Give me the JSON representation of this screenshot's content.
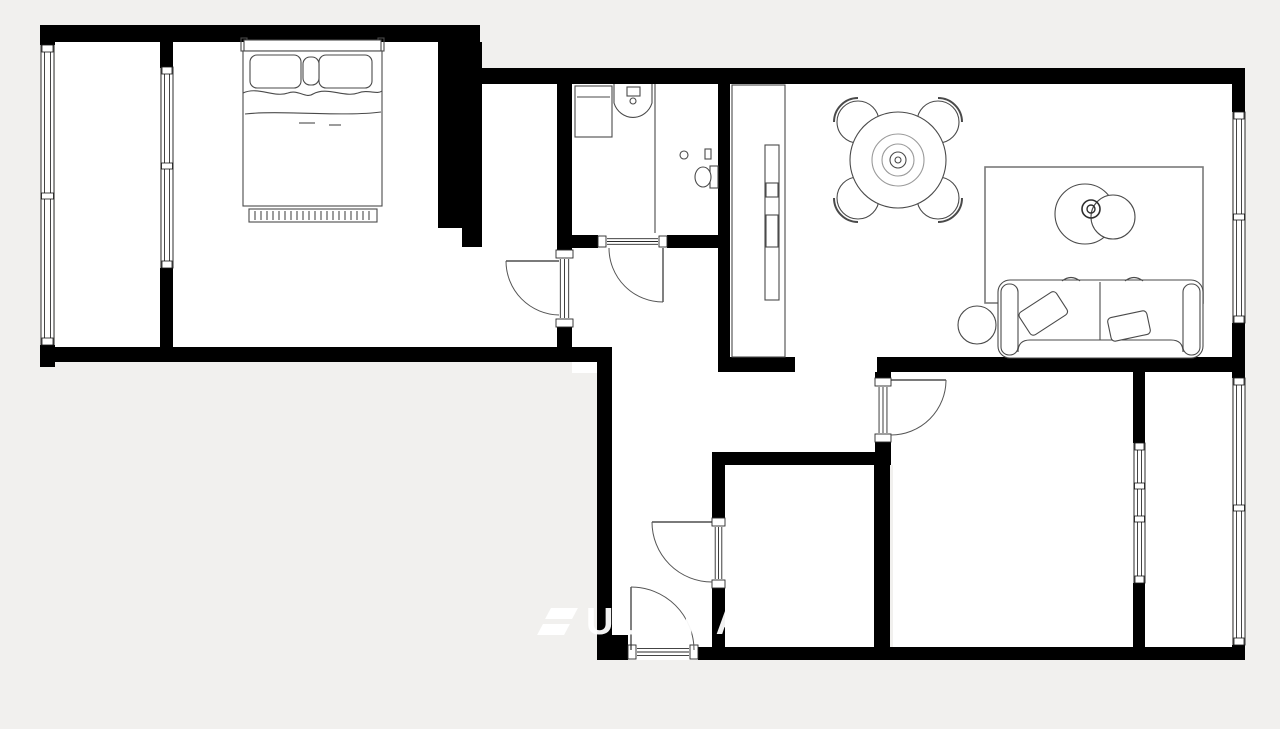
{
  "canvas": {
    "width": 1280,
    "height": 729,
    "bg_color": "#f1f0ee",
    "floor_color": "#ffffff",
    "wall_color": "#000000",
    "furniture_line_color": "#4a4a4a",
    "door_line_color": "#2a2a2a",
    "arc_color": "#555555",
    "window_frame_color": "#161616"
  },
  "watermark": {
    "text": "UUBRA",
    "color": "rgba(255,255,255,0.95)",
    "x": 540,
    "y": 606
  },
  "plan": {
    "floors": [
      {
        "name": "balcony-floor",
        "x": 55,
        "y": 42,
        "w": 105,
        "h": 305
      },
      {
        "name": "bedroom-floor",
        "x": 173,
        "y": 42,
        "w": 265,
        "h": 305
      },
      {
        "name": "bedroom-floor-ext",
        "x": 438,
        "y": 228,
        "w": 44,
        "h": 119
      },
      {
        "name": "bedroom-alcove-floor",
        "x": 474,
        "y": 84,
        "w": 86,
        "h": 263
      },
      {
        "name": "bathroom-floor",
        "x": 572,
        "y": 84,
        "w": 146,
        "h": 151
      },
      {
        "name": "hall-upper-floor",
        "x": 572,
        "y": 235,
        "w": 146,
        "h": 138
      },
      {
        "name": "hall-lower-floor",
        "x": 612,
        "y": 362,
        "w": 100,
        "h": 286
      },
      {
        "name": "corridor-floor",
        "x": 712,
        "y": 372,
        "w": 181,
        "h": 93
      },
      {
        "name": "storage-room-floor",
        "x": 725,
        "y": 465,
        "w": 149,
        "h": 183
      },
      {
        "name": "living-room-floor",
        "x": 730,
        "y": 84,
        "w": 502,
        "h": 288
      },
      {
        "name": "bedroom2-loggia-floor",
        "x": 893,
        "y": 372,
        "w": 339,
        "h": 276
      }
    ],
    "walls": [
      {
        "name": "top-left-wall",
        "x": 40,
        "y": 25,
        "w": 440,
        "h": 17
      },
      {
        "name": "left-wall-top-corner",
        "x": 40,
        "y": 25,
        "w": 15,
        "h": 20
      },
      {
        "name": "left-wall-bottom-corner",
        "x": 40,
        "y": 345,
        "w": 15,
        "h": 22
      },
      {
        "name": "bedroom-bottom-wall",
        "x": 40,
        "y": 347,
        "w": 572,
        "h": 15
      },
      {
        "name": "hall-left-wall",
        "x": 597,
        "y": 362,
        "w": 15,
        "h": 280
      },
      {
        "name": "hall-bottom-step",
        "x": 597,
        "y": 635,
        "w": 31,
        "h": 25
      },
      {
        "name": "top-right-wall",
        "x": 480,
        "y": 68,
        "w": 752,
        "h": 16
      },
      {
        "name": "top-right-corner",
        "x": 1232,
        "y": 68,
        "w": 13,
        "h": 44
      },
      {
        "name": "right-wall-mid-block",
        "x": 1232,
        "y": 323,
        "w": 13,
        "h": 55
      },
      {
        "name": "right-wall-bottom-corner",
        "x": 1232,
        "y": 645,
        "w": 13,
        "h": 15
      },
      {
        "name": "bottom-wall",
        "x": 698,
        "y": 647,
        "w": 547,
        "h": 13
      },
      {
        "name": "bedroom-pillar",
        "x": 438,
        "y": 42,
        "w": 44,
        "h": 186
      },
      {
        "name": "bedroom-pillar-notch",
        "x": 462,
        "y": 228,
        "w": 20,
        "h": 19
      },
      {
        "name": "bathroom-left-wall-upper",
        "x": 557,
        "y": 84,
        "w": 15,
        "h": 166
      },
      {
        "name": "bathroom-left-wall-lower",
        "x": 557,
        "y": 327,
        "w": 15,
        "h": 22
      },
      {
        "name": "bathroom-bottom-wall-left",
        "x": 572,
        "y": 235,
        "w": 26,
        "h": 13
      },
      {
        "name": "bathroom-bottom-wall-right",
        "x": 667,
        "y": 235,
        "w": 51,
        "h": 13
      },
      {
        "name": "bathroom-right-wall",
        "x": 718,
        "y": 84,
        "w": 12,
        "h": 288
      },
      {
        "name": "living-bottom-wall-left",
        "x": 730,
        "y": 357,
        "w": 65,
        "h": 15
      },
      {
        "name": "living-bottom-wall-right",
        "x": 877,
        "y": 357,
        "w": 355,
        "h": 15
      },
      {
        "name": "bedroom2-door-block-top",
        "x": 875,
        "y": 372,
        "w": 16,
        "h": 8
      },
      {
        "name": "bedroom2-door-block-bottom",
        "x": 875,
        "y": 440,
        "w": 16,
        "h": 25
      },
      {
        "name": "storage-top-wall",
        "x": 712,
        "y": 452,
        "w": 178,
        "h": 13
      },
      {
        "name": "storage-left-wall-upper",
        "x": 712,
        "y": 465,
        "w": 13,
        "h": 55
      },
      {
        "name": "storage-left-wall-lower",
        "x": 712,
        "y": 586,
        "w": 13,
        "h": 64
      },
      {
        "name": "storage-right-wall",
        "x": 874,
        "y": 465,
        "w": 16,
        "h": 185
      },
      {
        "name": "loggia-partition-top",
        "x": 1133,
        "y": 372,
        "w": 12,
        "h": 71
      },
      {
        "name": "loggia-partition-bottom",
        "x": 1133,
        "y": 583,
        "w": 12,
        "h": 64
      },
      {
        "name": "balcony-partition-top",
        "x": 160,
        "y": 28,
        "w": 13,
        "h": 40
      },
      {
        "name": "balcony-partition-bottom",
        "x": 160,
        "y": 268,
        "w": 13,
        "h": 79
      }
    ],
    "windows": [
      {
        "name": "balcony-exterior-window",
        "orient": "v",
        "x": 41,
        "y": 45,
        "w": 13,
        "h": 300,
        "dividers": [
          193
        ]
      },
      {
        "name": "bedroom-balcony-partition-window",
        "orient": "v",
        "x": 161,
        "y": 67,
        "w": 12,
        "h": 201,
        "dividers": [
          163
        ]
      },
      {
        "name": "living-room-window",
        "orient": "v",
        "x": 1233,
        "y": 112,
        "w": 12,
        "h": 211,
        "dividers": [
          214
        ]
      },
      {
        "name": "loggia-exterior-window",
        "orient": "v",
        "x": 1233,
        "y": 378,
        "w": 12,
        "h": 267,
        "dividers": [
          505
        ]
      },
      {
        "name": "bedroom2-loggia-partition-window",
        "orient": "v",
        "x": 1134,
        "y": 443,
        "w": 11,
        "h": 140,
        "dividers": [
          483,
          516
        ]
      }
    ],
    "doors": [
      {
        "name": "bedroom-door",
        "orient": "v",
        "threshold": {
          "x": 555,
          "y": 250,
          "w": 19,
          "h": 77
        },
        "leaf": {
          "x1": 506,
          "y1": 261,
          "x2": 559,
          "y2": 261
        },
        "arc": "M506 261 A54 54 0 0 0 559 315"
      },
      {
        "name": "bathroom-door",
        "orient": "h",
        "threshold": {
          "x": 598,
          "y": 235,
          "w": 69,
          "h": 13
        },
        "leaf": {
          "x1": 663,
          "y1": 248,
          "x2": 663,
          "y2": 302
        },
        "arc": "M609 248 A54 54 0 0 0 663 302"
      },
      {
        "name": "storage-door",
        "orient": "v",
        "threshold": {
          "x": 711,
          "y": 518,
          "w": 15,
          "h": 70
        },
        "leaf": {
          "x1": 652,
          "y1": 522,
          "x2": 712,
          "y2": 522
        },
        "arc": "M652 522 A60 60 0 0 0 712 582"
      },
      {
        "name": "bedroom2-door",
        "orient": "v",
        "threshold": {
          "x": 874,
          "y": 378,
          "w": 18,
          "h": 64
        },
        "leaf": {
          "x1": 891,
          "y1": 380,
          "x2": 946,
          "y2": 380
        },
        "arc": "M946 380 A55 55 0 0 1 891 435"
      },
      {
        "name": "entrance-door",
        "orient": "h",
        "threshold": {
          "x": 628,
          "y": 644,
          "w": 70,
          "h": 16
        },
        "leaf": {
          "x1": 631,
          "y1": 587,
          "x2": 631,
          "y2": 650
        },
        "arc": "M631 587 A63 63 0 0 1 694 650"
      }
    ],
    "furniture": [
      {
        "name": "double-bed",
        "prims": [
          {
            "t": "rect",
            "x": 241,
            "y": 38,
            "w": 6,
            "h": 13
          },
          {
            "t": "rect",
            "x": 378,
            "y": 38,
            "w": 6,
            "h": 13
          },
          {
            "t": "rect",
            "x": 244,
            "y": 40,
            "w": 137,
            "h": 11,
            "fill": "#fff"
          },
          {
            "t": "rect",
            "x": 243,
            "y": 51,
            "w": 139,
            "h": 155,
            "fill": "#fff"
          },
          {
            "t": "rect",
            "x": 250,
            "y": 55,
            "w": 51,
            "h": 33,
            "rx": 7,
            "fill": "#fff"
          },
          {
            "t": "rect",
            "x": 319,
            "y": 55,
            "w": 53,
            "h": 33,
            "rx": 7,
            "fill": "#fff"
          },
          {
            "t": "rect",
            "x": 303,
            "y": 57,
            "w": 16,
            "h": 28,
            "rx": 7,
            "fill": "#fff"
          },
          {
            "t": "path",
            "d": "M243 93 C258 86 274 98 288 93 C298 89 306 99 313 94 C327 86 344 98 358 93 C368 89 377 95 382 91"
          },
          {
            "t": "path",
            "d": "M245 114 C280 110 344 117 381 112"
          },
          {
            "t": "line",
            "x1": 299,
            "y1": 123,
            "x2": 315,
            "y2": 123
          },
          {
            "t": "line",
            "x1": 329,
            "y1": 125,
            "x2": 341,
            "y2": 125
          },
          {
            "t": "rect",
            "x": 249,
            "y": 209,
            "w": 128,
            "h": 13,
            "fill": "#fff"
          },
          {
            "t": "path",
            "d": "M255 211V220M261 211V220M267 211V220M273 211V220M279 211V220M285 211V220M291 211V220M297 211V220M303 211V220M309 211V220M315 211V220M321 211V220M327 211V220M333 211V220M339 211V220M345 211V220M351 211V220M357 211V220M363 211V220M369 211V220"
          }
        ]
      },
      {
        "name": "washing-machine",
        "prims": [
          {
            "t": "rect",
            "x": 575,
            "y": 86,
            "w": 37,
            "h": 51,
            "fill": "#fff"
          },
          {
            "t": "line",
            "x1": 577,
            "y1": 97,
            "x2": 610,
            "y2": 97
          }
        ]
      },
      {
        "name": "bathroom-sink",
        "prims": [
          {
            "t": "path",
            "d": "M614 84 L614 103 A20 21 0 0 0 652 103 L652 84",
            "fill": "#fff"
          },
          {
            "t": "rect",
            "x": 627,
            "y": 87,
            "w": 13,
            "h": 9,
            "fill": "#fff"
          },
          {
            "t": "circle",
            "cx": 633,
            "cy": 101,
            "r": 3
          }
        ]
      },
      {
        "name": "shower-divider",
        "prims": [
          {
            "t": "line",
            "x1": 655,
            "y1": 84,
            "x2": 655,
            "y2": 233
          },
          {
            "t": "circle",
            "cx": 684,
            "cy": 155,
            "r": 4
          },
          {
            "t": "rect",
            "x": 705,
            "y": 149,
            "w": 6,
            "h": 10
          }
        ]
      },
      {
        "name": "toilet",
        "prims": [
          {
            "t": "rect",
            "x": 710,
            "y": 166,
            "w": 8,
            "h": 22,
            "fill": "#fff"
          },
          {
            "t": "ellipse",
            "cx": 703,
            "cy": 177,
            "rx": 8,
            "ry": 10,
            "fill": "#fff"
          }
        ]
      },
      {
        "name": "wardrobe",
        "prims": [
          {
            "t": "rect",
            "x": 732,
            "y": 85,
            "w": 53,
            "h": 272,
            "fill": "#fff"
          },
          {
            "t": "rect",
            "x": 765,
            "y": 145,
            "w": 14,
            "h": 155,
            "fill": "#fff"
          },
          {
            "t": "rect",
            "x": 766,
            "y": 183,
            "w": 12,
            "h": 14
          },
          {
            "t": "rect",
            "x": 766,
            "y": 215,
            "w": 12,
            "h": 32
          }
        ]
      },
      {
        "name": "dining-set",
        "prims": [
          {
            "t": "circle",
            "cx": 858,
            "cy": 122,
            "r": 21,
            "fill": "#fff"
          },
          {
            "t": "path",
            "d": "M834 122 A24 24 0 0 1 858 98",
            "sw": 2
          },
          {
            "t": "circle",
            "cx": 938,
            "cy": 122,
            "r": 21,
            "fill": "#fff"
          },
          {
            "t": "path",
            "d": "M938 98 A24 24 0 0 1 962 122",
            "sw": 2
          },
          {
            "t": "circle",
            "cx": 858,
            "cy": 198,
            "r": 21,
            "fill": "#fff"
          },
          {
            "t": "path",
            "d": "M858 222 A24 24 0 0 1 834 198",
            "sw": 2
          },
          {
            "t": "circle",
            "cx": 938,
            "cy": 198,
            "r": 21,
            "fill": "#fff"
          },
          {
            "t": "path",
            "d": "M962 198 A24 24 0 0 1 938 222",
            "sw": 2
          },
          {
            "t": "circle",
            "cx": 898,
            "cy": 160,
            "r": 48,
            "fill": "#fff"
          },
          {
            "t": "circle",
            "cx": 898,
            "cy": 160,
            "r": 26,
            "stroke": "#9a9a9a"
          },
          {
            "t": "circle",
            "cx": 898,
            "cy": 160,
            "r": 16,
            "stroke": "#9a9a9a"
          },
          {
            "t": "circle",
            "cx": 898,
            "cy": 160,
            "r": 8
          },
          {
            "t": "circle",
            "cx": 898,
            "cy": 160,
            "r": 3
          }
        ]
      },
      {
        "name": "rug",
        "prims": [
          {
            "t": "rect",
            "x": 985,
            "y": 167,
            "w": 218,
            "h": 136,
            "stroke": "#7a7a7a",
            "sw": 1.6
          }
        ]
      },
      {
        "name": "coffee-table",
        "prims": [
          {
            "t": "circle",
            "cx": 1085,
            "cy": 214,
            "r": 30,
            "fill": "#fff"
          },
          {
            "t": "circle",
            "cx": 1113,
            "cy": 217,
            "r": 22,
            "fill": "#fff"
          },
          {
            "t": "circle",
            "cx": 1091,
            "cy": 209,
            "r": 9,
            "sw": 1.6,
            "stroke": "#2e2e2e"
          },
          {
            "t": "circle",
            "cx": 1091,
            "cy": 209,
            "r": 4,
            "sw": 1.4,
            "stroke": "#2e2e2e"
          }
        ]
      },
      {
        "name": "sofa",
        "prims": [
          {
            "t": "rect",
            "x": 998,
            "y": 280,
            "w": 205,
            "h": 78,
            "rx": 12,
            "fill": "#fff"
          },
          {
            "t": "rect",
            "x": 1001,
            "y": 284,
            "w": 17,
            "h": 71,
            "rx": 8,
            "fill": "#fff"
          },
          {
            "t": "rect",
            "x": 1183,
            "y": 284,
            "w": 17,
            "h": 71,
            "rx": 8,
            "fill": "#fff"
          },
          {
            "t": "path",
            "d": "M1018 352 Q1018 340 1030 340 L1171 340 Q1183 340 1183 352"
          },
          {
            "t": "line",
            "x1": 1100,
            "y1": 282,
            "x2": 1100,
            "y2": 340
          },
          {
            "t": "path",
            "d": "M1062 281 Q1071 274 1080 281 M1125 281 Q1134 274 1143 281"
          },
          {
            "t": "rect",
            "x": 1021,
            "y": 300,
            "w": 44,
            "h": 27,
            "rx": 4,
            "fill": "#fff",
            "transform": "rotate(-33 1043 313)"
          },
          {
            "t": "rect",
            "x": 1109,
            "y": 314,
            "w": 40,
            "h": 24,
            "rx": 4,
            "fill": "#fff",
            "transform": "rotate(-12 1129 326)"
          }
        ]
      },
      {
        "name": "side-table",
        "prims": [
          {
            "t": "circle",
            "cx": 977,
            "cy": 325,
            "r": 19,
            "fill": "#fff"
          }
        ]
      }
    ]
  }
}
